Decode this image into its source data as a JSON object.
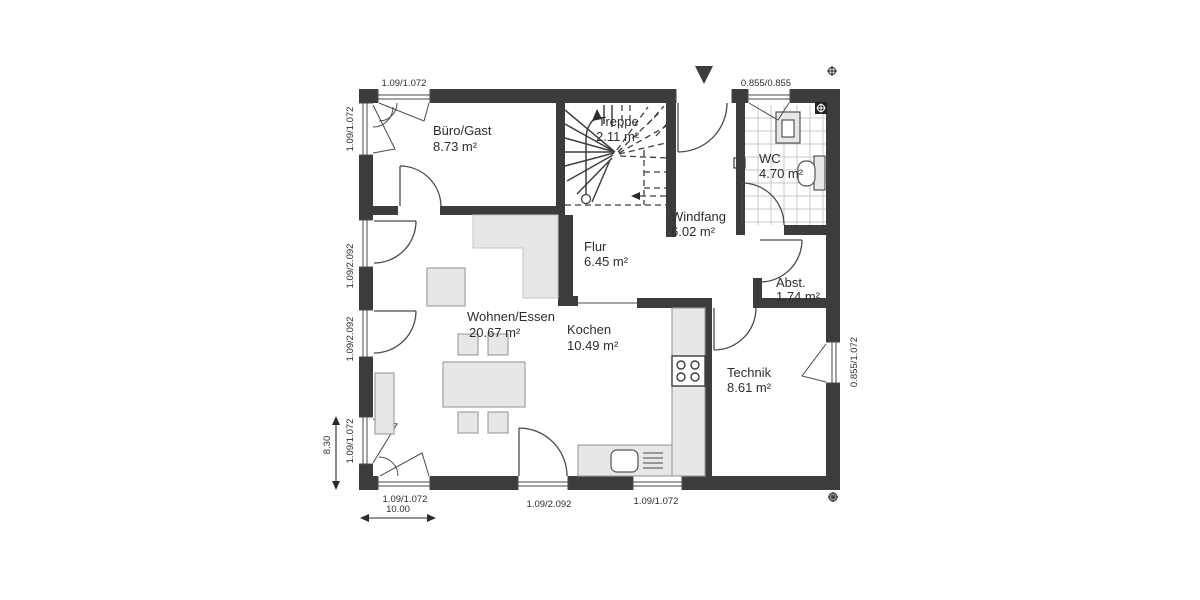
{
  "rooms": {
    "buero": {
      "name": "Büro/Gast",
      "area": "8.73 m²"
    },
    "treppe": {
      "name": "Treppe",
      "area": "2.11 m²"
    },
    "wc": {
      "name": "WC",
      "area": "4.70 m²"
    },
    "windfang": {
      "name": "Windfang",
      "area": "6.02 m²"
    },
    "flur": {
      "name": "Flur",
      "area": "6.45 m²"
    },
    "abst": {
      "name": "Abst.",
      "area": "1.74 m²"
    },
    "wohnen": {
      "name": "Wohnen/Essen",
      "area": "20.67 m²"
    },
    "kochen": {
      "name": "Kochen",
      "area": "10.49 m²"
    },
    "technik": {
      "name": "Technik",
      "area": "8.61 m²"
    }
  },
  "dimensions": {
    "top_left": "1.09/1.072",
    "top_right": "0.855/0.855",
    "left_1": "1.09/1.072",
    "left_2": "1.09/2.092",
    "left_3": "1.09/2.092",
    "left_4": "1.09/1.072",
    "bottom_left": "1.09/1.072",
    "bottom_center": "1.09/2.092",
    "bottom_right": "1.09/1.072",
    "right_1": "0.855/1.072",
    "overall_width": "10.00",
    "overall_height": "8.30"
  },
  "colors": {
    "wall": "#3c3c3c",
    "furniture": "#e7e7e7",
    "tile_line": "#c9c9c9",
    "text": "#2d2d2d",
    "background": "#ffffff"
  }
}
